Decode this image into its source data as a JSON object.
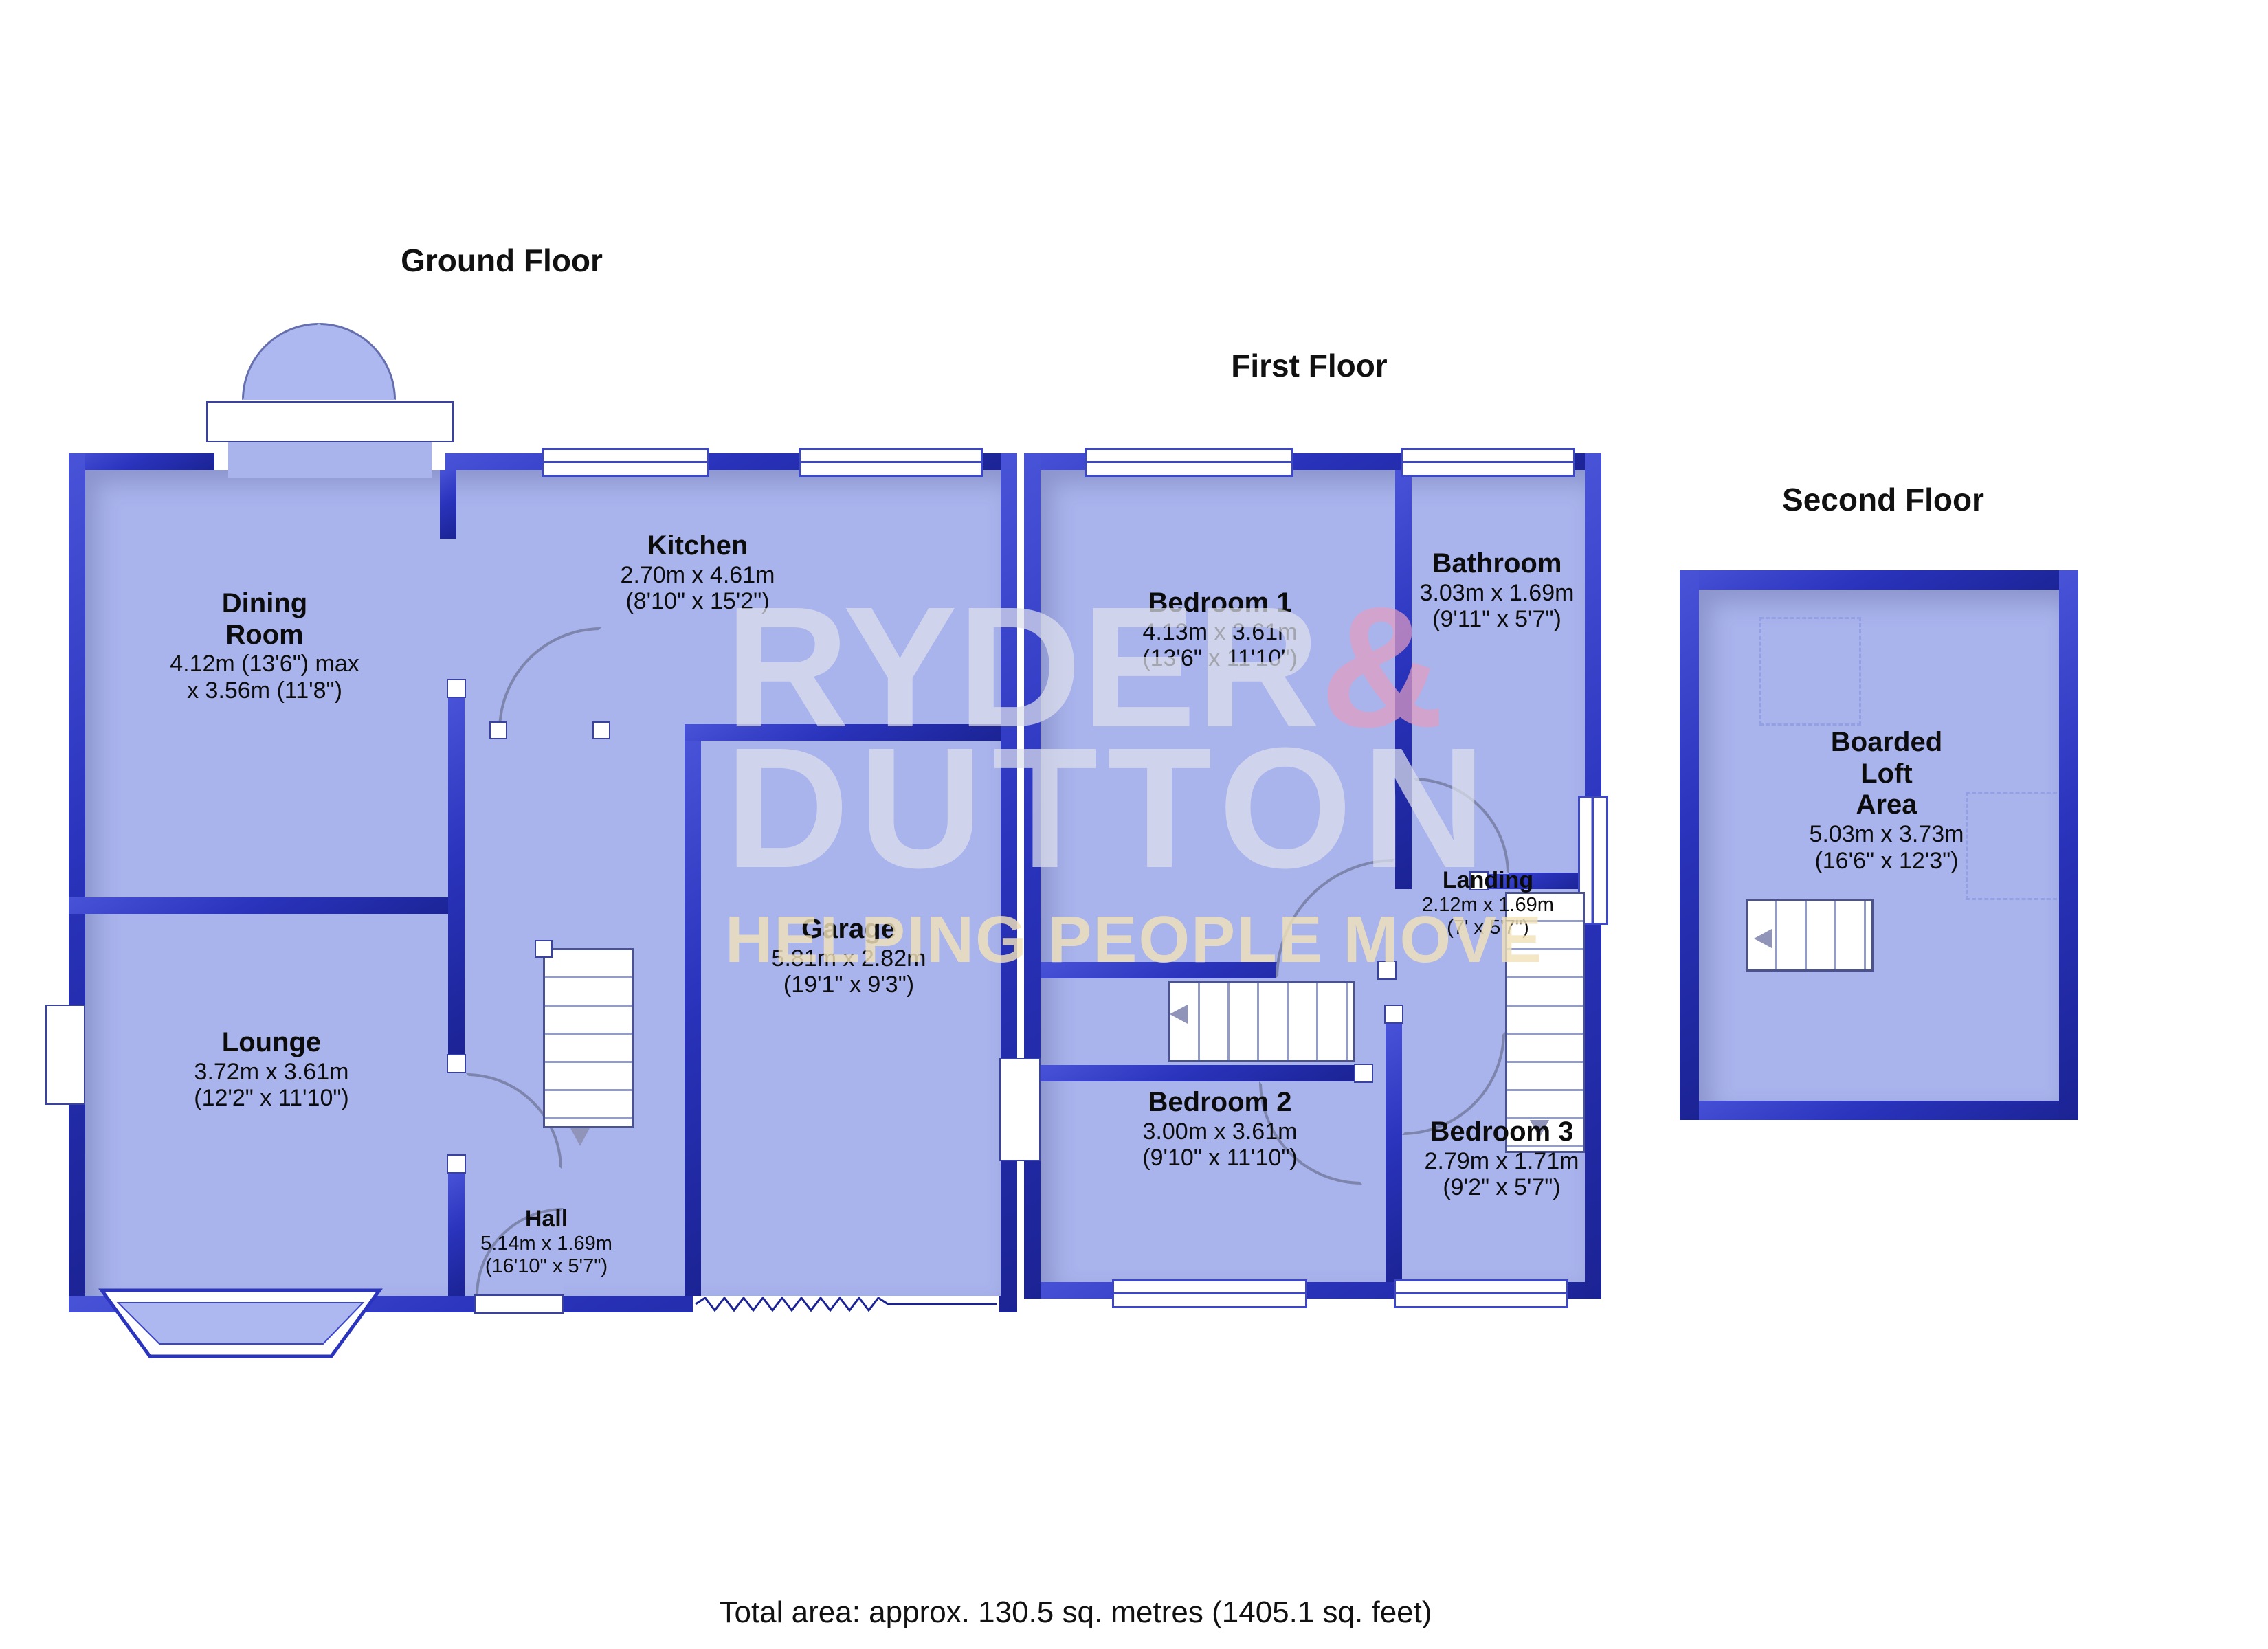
{
  "titles": {
    "ground": "Ground Floor",
    "first": "First Floor",
    "second": "Second Floor"
  },
  "rooms": {
    "dining": {
      "name1": "Dining",
      "name2": "Room",
      "dim1": "4.12m (13'6\") max",
      "dim2": "x 3.56m (11'8\")"
    },
    "kitchen": {
      "name": "Kitchen",
      "dim1": "2.70m x 4.61m",
      "dim2": "(8'10\" x 15'2\")"
    },
    "lounge": {
      "name": "Lounge",
      "dim1": "3.72m x 3.61m",
      "dim2": "(12'2\" x 11'10\")"
    },
    "garage": {
      "name": "Garage",
      "dim1": "5.81m x 2.82m",
      "dim2": "(19'1\" x 9'3\")"
    },
    "hall": {
      "name": "Hall",
      "dim1": "5.14m x 1.69m",
      "dim2": "(16'10\" x 5'7\")"
    },
    "bedroom1": {
      "name": "Bedroom 1",
      "dim1": "4.13m x 3.61m",
      "dim2": "(13'6\" x 11'10\")"
    },
    "bathroom": {
      "name": "Bathroom",
      "dim1": "3.03m x 1.69m",
      "dim2": "(9'11\" x 5'7\")"
    },
    "landing": {
      "name": "Landing",
      "dim1": "2.12m x 1.69m",
      "dim2": "(7' x 5'7\")"
    },
    "bedroom2": {
      "name": "Bedroom 2",
      "dim1": "3.00m x 3.61m",
      "dim2": "(9'10\" x 11'10\")"
    },
    "bedroom3": {
      "name": "Bedroom 3",
      "dim1": "2.79m x 1.71m",
      "dim2": "(9'2\" x 5'7\")"
    },
    "loft": {
      "name1": "Boarded",
      "name2": "Loft",
      "name3": "Area",
      "dim1": "5.03m x 3.73m",
      "dim2": "(16'6\" x 12'3\")"
    }
  },
  "watermark": {
    "brand1": "RYDER",
    "amp": "&",
    "brand2": "DUTTON",
    "tagline": "HELPING PEOPLE MOVE"
  },
  "footer": {
    "total_area": "Total area: approx. 130.5 sq. metres (1405.1 sq. feet)"
  },
  "colors": {
    "wall_blue": "#2a34bd",
    "room_fill": "#a9b3ec",
    "watermark_pink": "#e49ec0",
    "watermark_cream": "#f0e2b9"
  }
}
